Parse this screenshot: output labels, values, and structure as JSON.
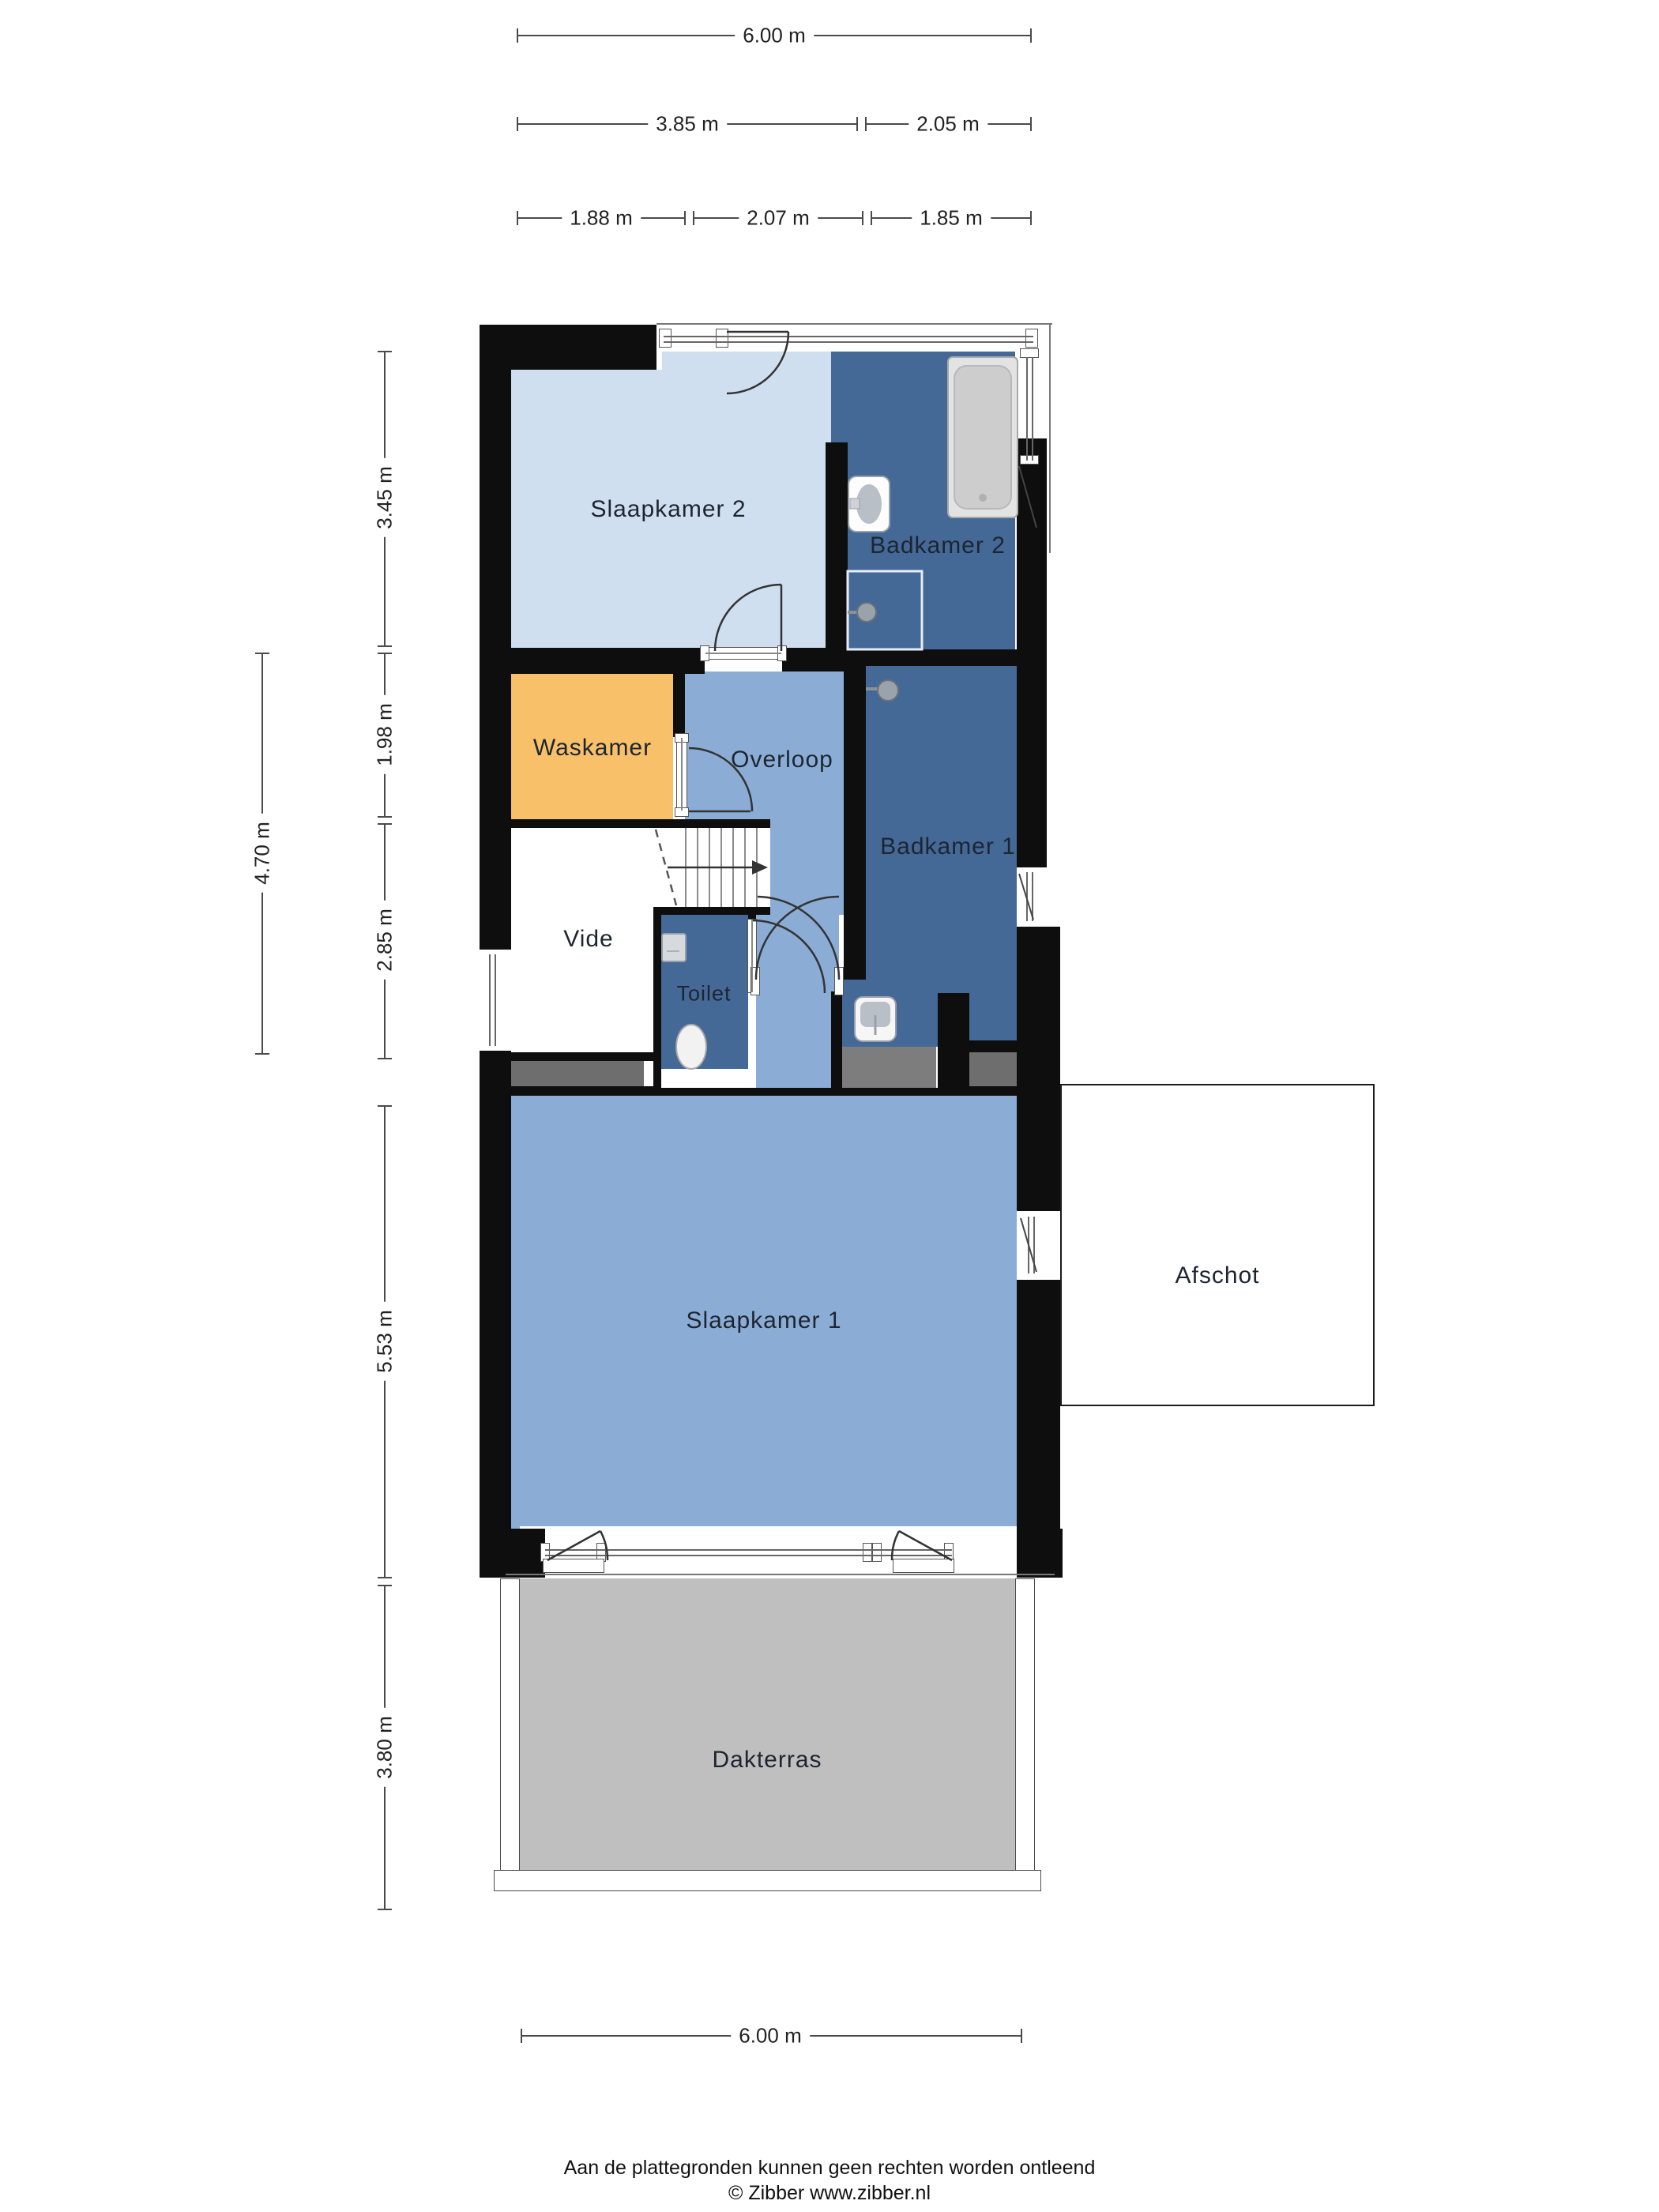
{
  "colors": {
    "wall": "#0e0e0e",
    "room_light_blue": "#d0dff0",
    "room_medium_blue": "#8badd5",
    "room_dark_blue": "#446997",
    "room_orange": "#f8c169",
    "terrace_gray": "#bfbfbf",
    "counter_gray": "#7d7d7d",
    "strip_gray": "#6e6e6e",
    "dim_line": "#4a4a4a",
    "label_text": "#1d2531"
  },
  "rooms": {
    "slaapkamer2": {
      "label": "Slaapkamer 2"
    },
    "badkamer2": {
      "label": "Badkamer 2"
    },
    "waskamer": {
      "label": "Waskamer"
    },
    "overloop": {
      "label": "Overloop"
    },
    "badkamer1": {
      "label": "Badkamer 1"
    },
    "vide": {
      "label": "Vide"
    },
    "toilet": {
      "label": "Toilet"
    },
    "slaapkamer1": {
      "label": "Slaapkamer 1"
    },
    "afschot": {
      "label": "Afschot"
    },
    "dakterras": {
      "label": "Dakterras"
    }
  },
  "dimensions": {
    "top_row1": [
      {
        "label": "6.00 m"
      }
    ],
    "top_row2": [
      {
        "label": "3.85 m"
      },
      {
        "label": "2.05 m"
      }
    ],
    "top_row3": [
      {
        "label": "1.88 m"
      },
      {
        "label": "2.07 m"
      },
      {
        "label": "1.85 m"
      }
    ],
    "left_inner": [
      {
        "label": "3.45 m"
      },
      {
        "label": "1.98 m"
      },
      {
        "label": "2.85 m"
      },
      {
        "label": "5.53 m"
      },
      {
        "label": "3.80 m"
      }
    ],
    "left_outer": [
      {
        "label": "4.70 m"
      }
    ],
    "bottom": [
      {
        "label": "6.00 m"
      }
    ]
  },
  "footer": {
    "disclaimer": "Aan de plattegronden kunnen geen rechten worden ontleend",
    "copyright": "© Zibber www.zibber.nl"
  }
}
